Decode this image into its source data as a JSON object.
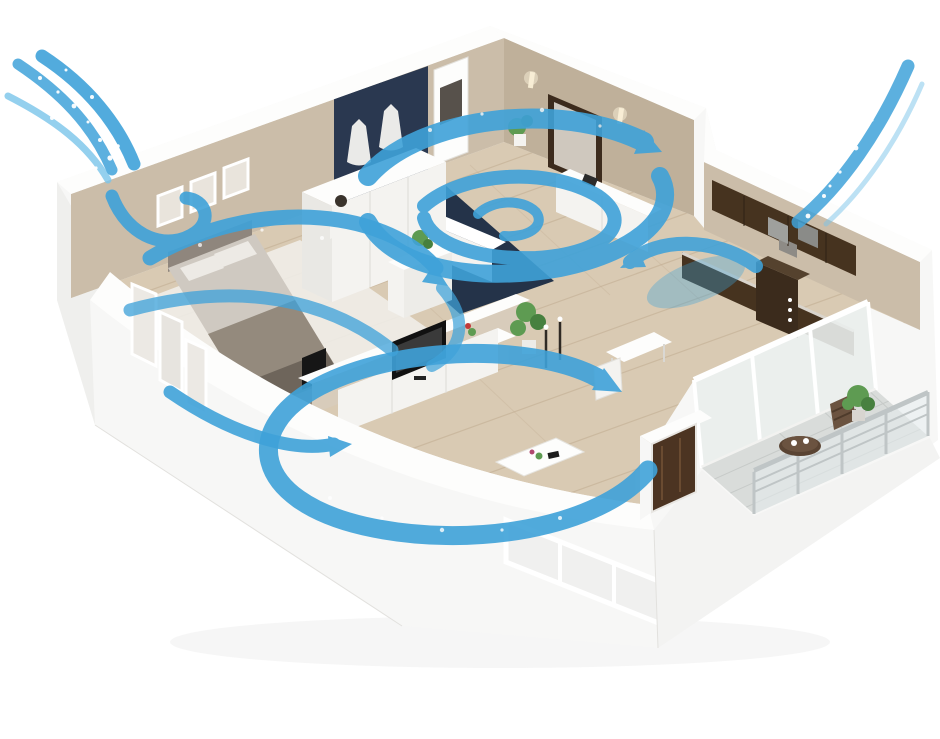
{
  "image_type": "3d-isometric-cutaway-floor-plan-illustration",
  "scene": {
    "view": "isometric cutaway apartment seen from above with whole-home airflow circulation",
    "background": "white",
    "rooms": [
      {
        "id": "bedroom",
        "position": "upper-left",
        "furniture": [
          "double-bed",
          "pillows",
          "nightstand-lamp",
          "wardrobe",
          "three-wall-frames",
          "small-tv"
        ]
      },
      {
        "id": "bathroom",
        "position": "top-center",
        "features": [
          "navy-mosaic-accent-wall",
          "navy-floor",
          "white-bathtub",
          "two-hanging-robes",
          "white-door"
        ]
      },
      {
        "id": "hallway",
        "position": "upper-right",
        "furniture": [
          "framed-mirror",
          "white-sideboard",
          "potted-plant",
          "wall-sconces",
          "white-dresser"
        ]
      },
      {
        "id": "kitchen",
        "position": "right-wing",
        "furniture": [
          "dark-wood-wall-cabinets",
          "counter-with-stove",
          "tall-dark-cabinet"
        ]
      },
      {
        "id": "living-room",
        "position": "center",
        "furniture": [
          "tv-console",
          "flatscreen-tv",
          "coffee-table",
          "dining-table",
          "white-chair",
          "tall-plant",
          "candle-stands"
        ]
      },
      {
        "id": "balcony",
        "position": "lower-right",
        "furniture": [
          "sliding-glass-doors",
          "round-table",
          "two-cups",
          "slat-chair",
          "potted-plant",
          "glass-railing"
        ]
      },
      {
        "id": "entry",
        "position": "center-right",
        "features": [
          "dark-wood-entry-door"
        ]
      }
    ],
    "airflow": {
      "intake_streams": [
        {
          "id": "intake-left",
          "position": "top-left",
          "streaks": 3,
          "has_sparkles": true
        },
        {
          "id": "intake-right",
          "position": "top-right",
          "streaks": 1,
          "has_sparkles": true
        }
      ],
      "swirls": [
        "bedroom-swirl",
        "bathroom-swirl",
        "kitchen-swirl",
        "living-room-swirl"
      ],
      "arrows": [
        "bedroom-window-loop",
        "bedroom-sweep-arrow",
        "bedroom-return-arrow",
        "bathroom-exit-arrow",
        "kitchen-inlet-arrow",
        "living-to-entry-arrow"
      ]
    },
    "windows": {
      "left_wall_panes": 3,
      "front_window_panes": 3,
      "bedroom_picture_frames": 3
    }
  },
  "colors": {
    "airflow_blue": "#3FA2D9",
    "airflow_blue_light": "#79C4EA",
    "airflow_blue_deep": "#2E86BE",
    "sparkle_white": "#FFFFFF",
    "wall_beige": "#CBBDA9",
    "wall_beige_dark": "#BFB09A",
    "wall_white": "#F7F7F6",
    "wall_white_bright": "#FDFDFC",
    "navy_wall": "#2A3850",
    "navy_floor": "#243349",
    "wood_floor": "#D9CAB3",
    "wood_plank_line": "#C4B096",
    "rug_white": "#EFEDE8",
    "cabinet_brown": "#46331F",
    "door_brown": "#4C3422",
    "mirror_frame": "#3C2B1D",
    "furniture_white": "#F4F3F0",
    "bed_gray": "#CFC9C1",
    "blanket_taupe": "#948A7D",
    "balcony_tile": "#D9DCDA",
    "railing_metal": "#BFC5C6",
    "plant_green": "#5E9B52",
    "plant_green_dark": "#47803F",
    "table_wood": "#5A4433",
    "shadow_gray": "#E8E8E6"
  }
}
